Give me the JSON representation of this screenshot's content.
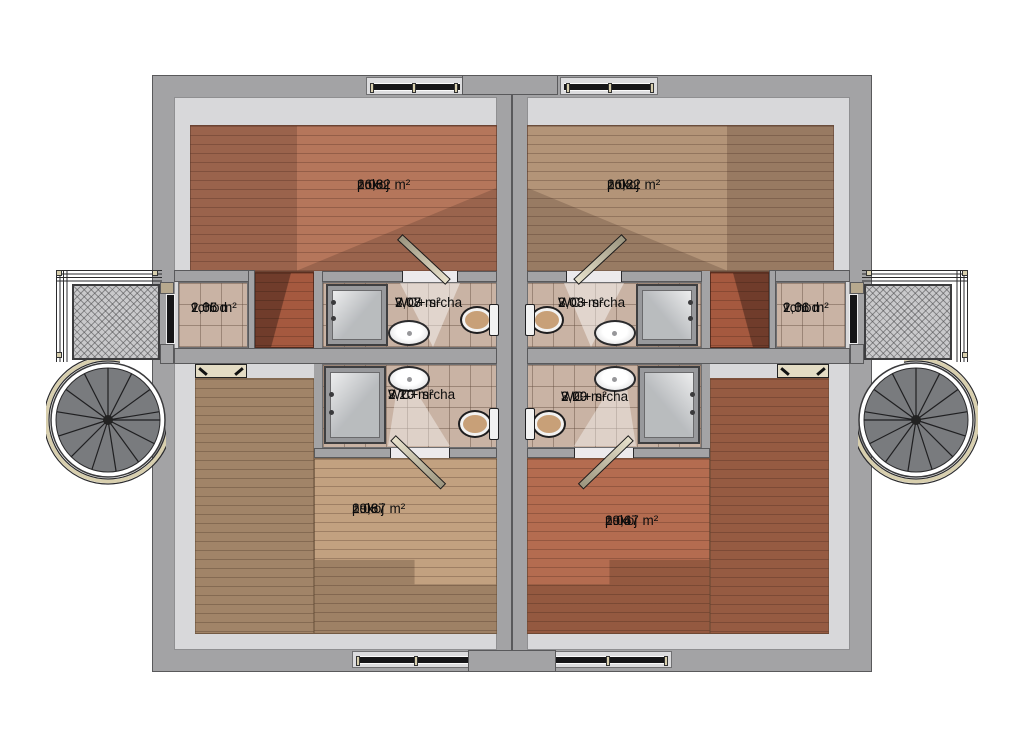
{
  "floorplan": {
    "rooms": [
      {
        "id": "2.06",
        "name": "pokoj",
        "area": "16,82 m²"
      },
      {
        "id": "2.02",
        "name": "pokoj",
        "area": "16,82 m²"
      },
      {
        "id": "2.07",
        "name": "WC+ srcha",
        "area": "3,08 m²"
      },
      {
        "id": "2.03",
        "name": "WC+ srcha",
        "area": "3,08 m²"
      },
      {
        "id": "2.05",
        "name": "vchod",
        "area": "1,66 m²"
      },
      {
        "id": "2.01",
        "name": "vchod",
        "area": "1,66 m²"
      },
      {
        "id": "2.10",
        "name": "WC+ srcha",
        "area": "3,20 m²"
      },
      {
        "id": "2.09",
        "name": "WC+ srcha",
        "area": "3,20 m²"
      },
      {
        "id": "2.08",
        "name": "pokoj",
        "area": "19,67 m²"
      },
      {
        "id": "2.04",
        "name": "pokoj",
        "area": "19,67 m²"
      }
    ],
    "colors": {
      "wall": "#a3a3a5",
      "wall_edge": "#59595b",
      "ceiling": "#d8d8da",
      "floor_red": "#b5765b",
      "floor_red2": "#b46c50",
      "floor_tan": "#b39478",
      "floor_tan2": "#c2a180",
      "roof_red": "#a5593f",
      "tile": "#c9b3a4",
      "door_panel": "#e4dcc4",
      "glass": "#161618",
      "rail": "#d8cfae",
      "grate": "#c9c9cb",
      "seat": "#c8a078"
    }
  }
}
